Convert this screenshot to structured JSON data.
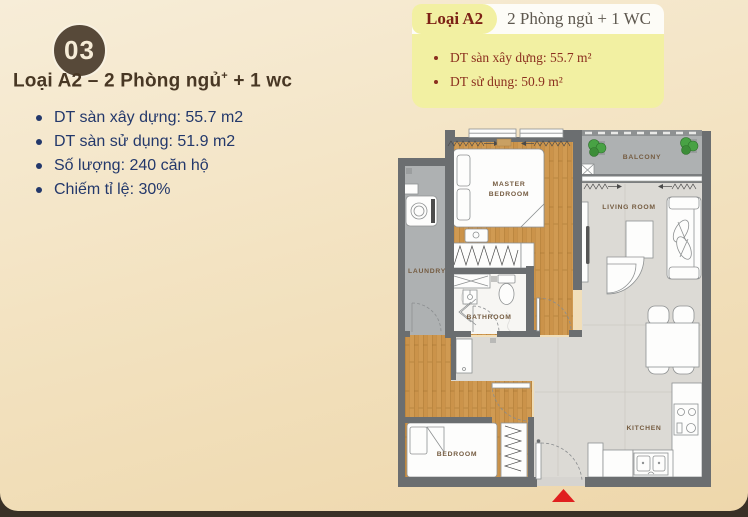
{
  "page": {
    "badge": "03",
    "heading": {
      "prefix": "Loại A2 – 2 Phòng ngủ",
      "sup": "+",
      "suffix": " + 1 wc"
    },
    "bullets": [
      "DT sàn xây dựng: 55.7 m2",
      "DT sàn sử dụng: 51.9 m2",
      "Số lượng: 240 căn hộ",
      "Chiếm tỉ lệ: 30%"
    ]
  },
  "card": {
    "type_label": "Loại A2",
    "subtitle": "2 Phòng ngủ + 1 WC",
    "bullets": [
      "DT sàn xây dựng: 55.7 m²",
      "DT sử dụng: 50.9 m²"
    ]
  },
  "floorplan": {
    "rooms": {
      "master_line1": "MASTER",
      "master_line2": "BEDROOM",
      "laundry": "LAUNDRY",
      "bathroom": "BATHROOM",
      "bedroom": "BEDROOM",
      "balcony": "BALCONY",
      "living": "LIVING ROOM",
      "kitchen": "KITCHEN"
    },
    "colors": {
      "wall": "#6b6e70",
      "wood_floor": "#d09a52",
      "service_floor": "#aeb1b2",
      "tile_floor": "#dcdad5",
      "room_label": "#755c41",
      "entrance_marker": "#e01f1f",
      "plant": "#48a244"
    }
  },
  "theme": {
    "background_top": "#f7edd8",
    "background_bottom": "#eed7ab",
    "footer_bar": "#3a3127",
    "badge_bg": "#574939",
    "badge_text": "#f6ecd7",
    "heading_text": "#483724",
    "list_text": "#23386b",
    "card_yellow": "#f2f0a2",
    "card_maroon": "#8b2f1f",
    "card_subtitle": "#5e584f"
  }
}
